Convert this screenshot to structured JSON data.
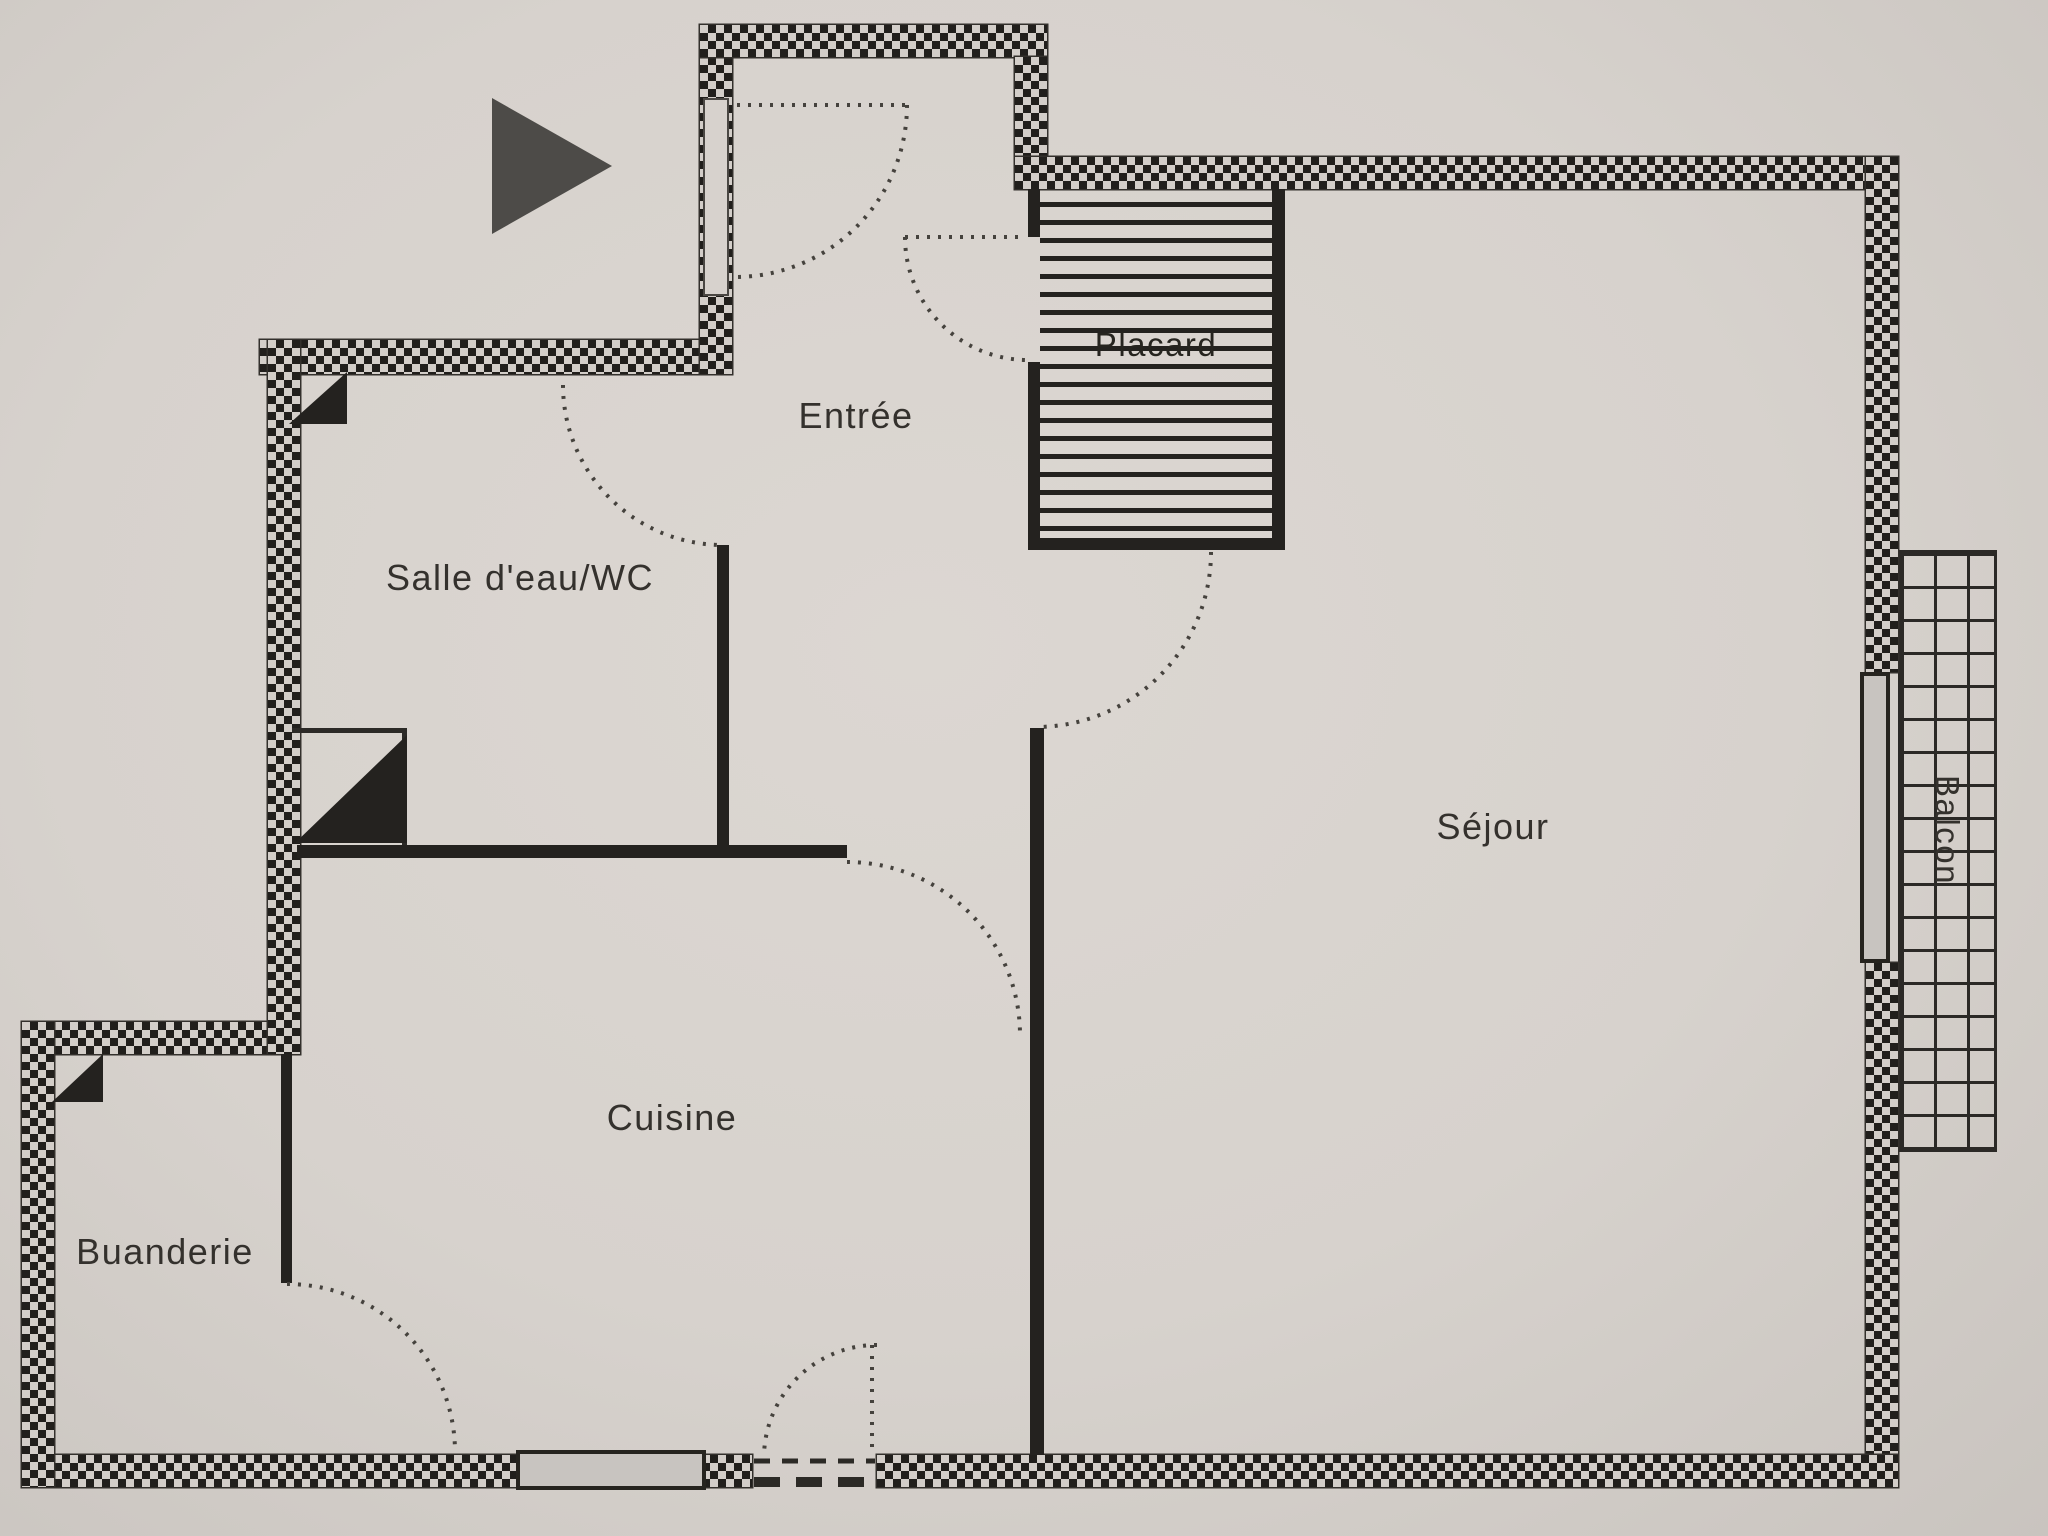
{
  "plan": {
    "type": "apartment-floor-plan",
    "rooms": [
      {
        "id": "entree",
        "label": "Entrée"
      },
      {
        "id": "placard",
        "label": "Placard"
      },
      {
        "id": "salle_deau_wc",
        "label": "Salle d'eau/WC"
      },
      {
        "id": "sejour",
        "label": "Séjour"
      },
      {
        "id": "cuisine",
        "label": "Cuisine"
      },
      {
        "id": "buanderie",
        "label": "Buanderie"
      },
      {
        "id": "balcon",
        "label": "Balcon"
      }
    ],
    "icons": [
      {
        "name": "north-arrow-icon",
        "shape": "solid-triangle-pointing-right"
      }
    ],
    "colors": {
      "paper": "#d7d2cd",
      "ink": "#24221f",
      "arrow_gray": "#4d4b48",
      "window_fill": "#c8c4c0"
    }
  }
}
